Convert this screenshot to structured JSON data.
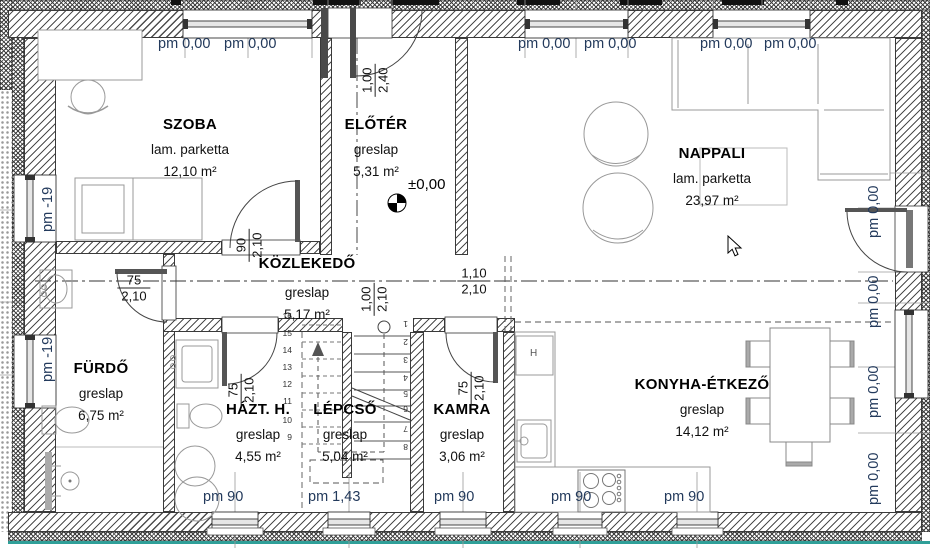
{
  "colors": {
    "pm_text": "#233a5c",
    "teal_strip": "#2f9f98",
    "dim_text": "#111111",
    "room_text": "#000000"
  },
  "rooms": [
    {
      "name": "SZOBA",
      "floor": "lam. parketta",
      "area": "12,10 m²",
      "x": 190,
      "y": 116
    },
    {
      "name": "ELŐTÉR",
      "floor": "greslap",
      "area": "5,31 m²",
      "x": 376,
      "y": 116
    },
    {
      "name": "NAPPALI",
      "floor": "lam. parketta",
      "area": "23,97 m²",
      "x": 712,
      "y": 145
    },
    {
      "name": "KÖZLEKEDŐ",
      "floor": "greslap",
      "area": "5,17 m²",
      "x": 307,
      "y": 255,
      "dy1": 30,
      "dy2": 52
    },
    {
      "name": "FÜRDŐ",
      "floor": "greslap",
      "area": "6,75 m²",
      "x": 101,
      "y": 360
    },
    {
      "name": "HÁZT. H.",
      "floor": "greslap",
      "area": "4,55 m²",
      "x": 258,
      "y": 401
    },
    {
      "name": "LÉPCSŐ",
      "floor": "greslap",
      "area": "5,04 m²",
      "x": 345,
      "y": 401
    },
    {
      "name": "KAMRA",
      "floor": "greslap",
      "area": "3,06 m²",
      "x": 462,
      "y": 401
    },
    {
      "name": "KONYHA-ÉTKEZŐ",
      "floor": "greslap",
      "area": "14,12 m²",
      "x": 702,
      "y": 376
    }
  ],
  "pm_labels": [
    {
      "text": "pm 0,00",
      "x": 158,
      "y": 36,
      "rot": 0
    },
    {
      "text": "pm 0,00",
      "x": 224,
      "y": 36,
      "rot": 0
    },
    {
      "text": "pm 0,00",
      "x": 518,
      "y": 36,
      "rot": 0
    },
    {
      "text": "pm 0,00",
      "x": 584,
      "y": 36,
      "rot": 0
    },
    {
      "text": "pm 0,00",
      "x": 700,
      "y": 36,
      "rot": 0
    },
    {
      "text": "pm 0,00",
      "x": 764,
      "y": 36,
      "rot": 0
    },
    {
      "text": "pm -19",
      "x": 40,
      "y": 232,
      "rot": 1
    },
    {
      "text": "pm -19",
      "x": 40,
      "y": 382,
      "rot": 1
    },
    {
      "text": "pm 0,00",
      "x": 866,
      "y": 238,
      "rot": 1
    },
    {
      "text": "pm 0,00",
      "x": 866,
      "y": 328,
      "rot": 1
    },
    {
      "text": "pm 0,00",
      "x": 866,
      "y": 418,
      "rot": 1
    },
    {
      "text": "pm 0,00",
      "x": 866,
      "y": 505,
      "rot": 1
    },
    {
      "text": "pm 90",
      "x": 203,
      "y": 489,
      "rot": 0
    },
    {
      "text": "pm 1,43",
      "x": 308,
      "y": 489,
      "rot": 0
    },
    {
      "text": "pm 90",
      "x": 434,
      "y": 489,
      "rot": 0
    },
    {
      "text": "pm 90",
      "x": 551,
      "y": 489,
      "rot": 0
    },
    {
      "text": "pm 90",
      "x": 664,
      "y": 489,
      "rot": 0
    }
  ],
  "dims": [
    {
      "num": "1,00",
      "den": "2,40",
      "cx": 374,
      "cy": 48,
      "rot": 1
    },
    {
      "num": "90",
      "den": "2,10",
      "cx": 248,
      "cy": 213,
      "rot": 1
    },
    {
      "num": "75",
      "den": "2,10",
      "cx": 134,
      "cy": 288,
      "rot": 0
    },
    {
      "num": "1,00",
      "den": "2,10",
      "cx": 373,
      "cy": 267,
      "rot": 1
    },
    {
      "num": "1,10",
      "den": "2,10",
      "cx": 474,
      "cy": 281,
      "rot": 0
    },
    {
      "num": "75",
      "den": "2,10",
      "cx": 240,
      "cy": 358,
      "rot": 1
    },
    {
      "num": "75",
      "den": "2,10",
      "cx": 470,
      "cy": 356,
      "rot": 1
    }
  ],
  "stair": {
    "left_numbers": [
      {
        "n": "16",
        "y": 311
      },
      {
        "n": "15",
        "y": 328
      },
      {
        "n": "14",
        "y": 345
      },
      {
        "n": "13",
        "y": 362
      },
      {
        "n": "12",
        "y": 379
      },
      {
        "n": "11",
        "y": 396
      },
      {
        "n": "10",
        "y": 415
      },
      {
        "n": "9",
        "y": 432
      }
    ],
    "right_numbers": [
      {
        "n": "1",
        "y": 319
      },
      {
        "n": "2",
        "y": 337
      },
      {
        "n": "3",
        "y": 355
      },
      {
        "n": "4",
        "y": 373
      },
      {
        "n": "5",
        "y": 389
      },
      {
        "n": "6",
        "y": 404
      },
      {
        "n": "7",
        "y": 424
      },
      {
        "n": "8",
        "y": 442
      }
    ]
  },
  "marker": {
    "text": "±0,00"
  },
  "kitchen": {
    "fridge_label": "H"
  }
}
